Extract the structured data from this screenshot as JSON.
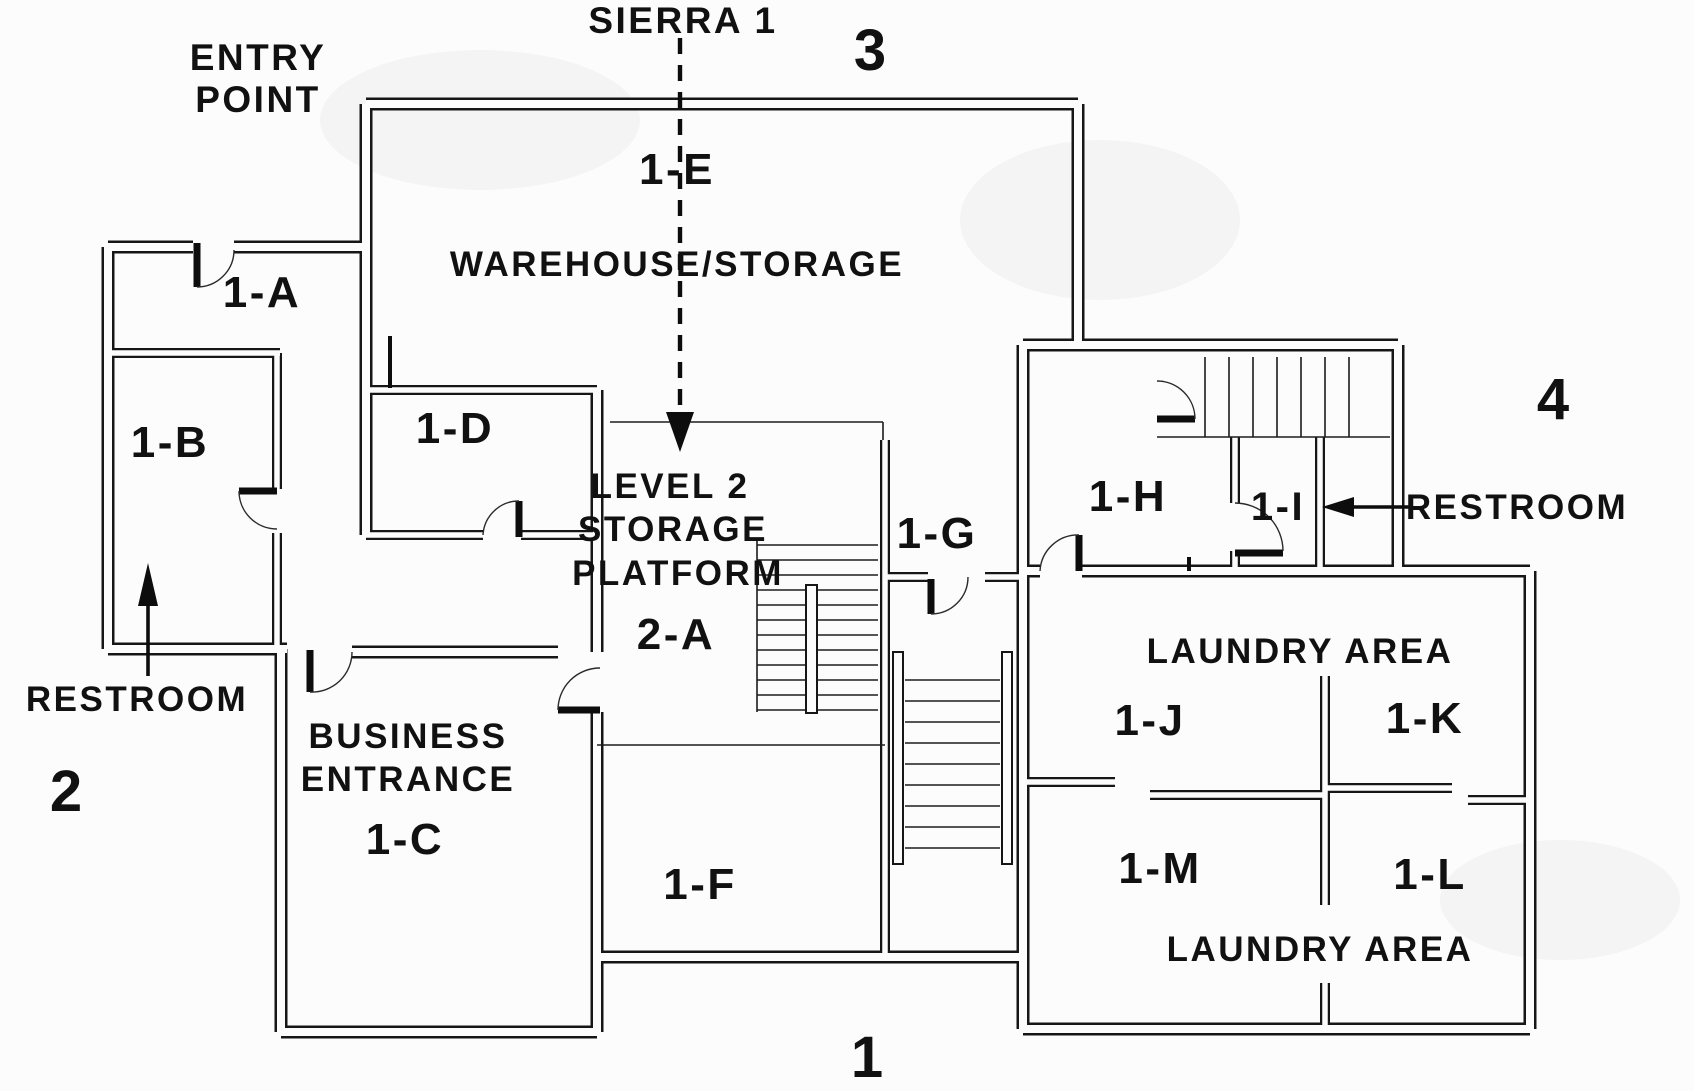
{
  "plan": {
    "name": "SIERRA 1",
    "colors": {
      "ink": "#111111",
      "background": "#fcfcfc"
    },
    "header": {
      "sierra_label": "SIERRA 1",
      "entry_point_line1": "ENTRY",
      "entry_point_line2": "POINT"
    },
    "corner_numbers": {
      "bottom": "1",
      "left": "2",
      "top": "3",
      "right": "4"
    },
    "annotations": {
      "restroom_left": "RESTROOM",
      "restroom_right": "RESTROOM"
    },
    "areas": {
      "warehouse_code": "1-E",
      "warehouse_name": "WAREHOUSE/STORAGE",
      "platform_line1": "LEVEL 2",
      "platform_line2": "STORAGE",
      "platform_line3": "PLATFORM",
      "platform_code": "2-A",
      "business_line1": "BUSINESS",
      "business_line2": "ENTRANCE",
      "business_code": "1-C",
      "laundry_top": "LAUNDRY AREA",
      "laundry_bottom": "LAUNDRY AREA"
    },
    "rooms": {
      "a": "1-A",
      "b": "1-B",
      "d": "1-D",
      "f": "1-F",
      "g": "1-G",
      "h": "1-H",
      "i": "1-I",
      "j": "1-J",
      "k": "1-K",
      "l": "1-L",
      "m": "1-M"
    },
    "icons": {
      "sierra_arrow": "dashed-down-arrow",
      "restroom_left_arrow": "up-arrow",
      "restroom_right_arrow": "left-arrow"
    }
  }
}
